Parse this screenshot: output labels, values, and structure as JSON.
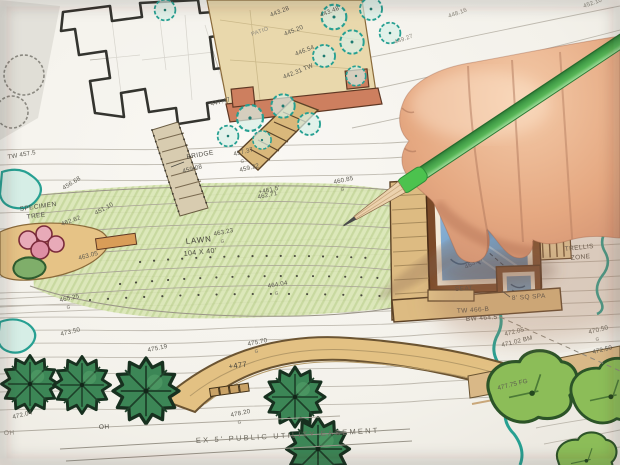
{
  "scene": {
    "description": "Photograph of a hand holding a green pencil over a hand-drawn, colored landscape architecture site plan",
    "type": "photo"
  },
  "plan": {
    "area_labels": {
      "specimen_tree_1": "SPECIMEN",
      "specimen_tree_2": "TREE",
      "lawn": "LAWN",
      "lawn_dims": "104 X 40'",
      "bridge": "BRIDGE",
      "patio": "PATIO",
      "pool": "POOL",
      "seat": "SEAT",
      "spa": "8' SQ SPA",
      "wall_top": "TW 466-B",
      "wall_bottom": "BW 464.5'",
      "trellis_1": "TRELLIS",
      "trellis_2": "ZONE",
      "easement": "EX 5' PUBLIC UTILITY EASEMENT",
      "berm_spot": "+477",
      "oh_1": "OH",
      "oh_2": "OH"
    },
    "grade_mark": "G",
    "elevations": [
      "463.23",
      "464.04",
      "465.25",
      "456.68",
      "451.10",
      "462.62",
      "463.05",
      "457.37",
      "459.22",
      "460.85",
      "462.71",
      "459.08",
      "443.28",
      "443.48",
      "445.20",
      "446.54",
      "442.31 TW",
      "447.47",
      "463.97",
      "+466",
      "475.19",
      "475.70",
      "478.20",
      "472.04",
      "473.50",
      "470.50",
      "472.05",
      "471.02 BM",
      "472.50",
      "477.75 FG",
      "TW 457.5",
      "+461.5'",
      "452.10",
      "449.27",
      "448.16"
    ]
  },
  "colors": {
    "paper": "#f5f3ee",
    "lawn_green": "#d9e6b4",
    "shrub_teal": "#27a092",
    "tree_dark_green": "#3c8656",
    "tree_light_green": "#8cbd58",
    "patio_tan": "#e9d8ac",
    "wall_terracotta": "#cd7f5f",
    "pool_blue": "#6f9ec8",
    "deck_brown": "#7a4a28",
    "berm_tan": "#e3c183",
    "pencil_green": "#57b657",
    "skin": "#e9b896",
    "ink": "#5a584f"
  }
}
